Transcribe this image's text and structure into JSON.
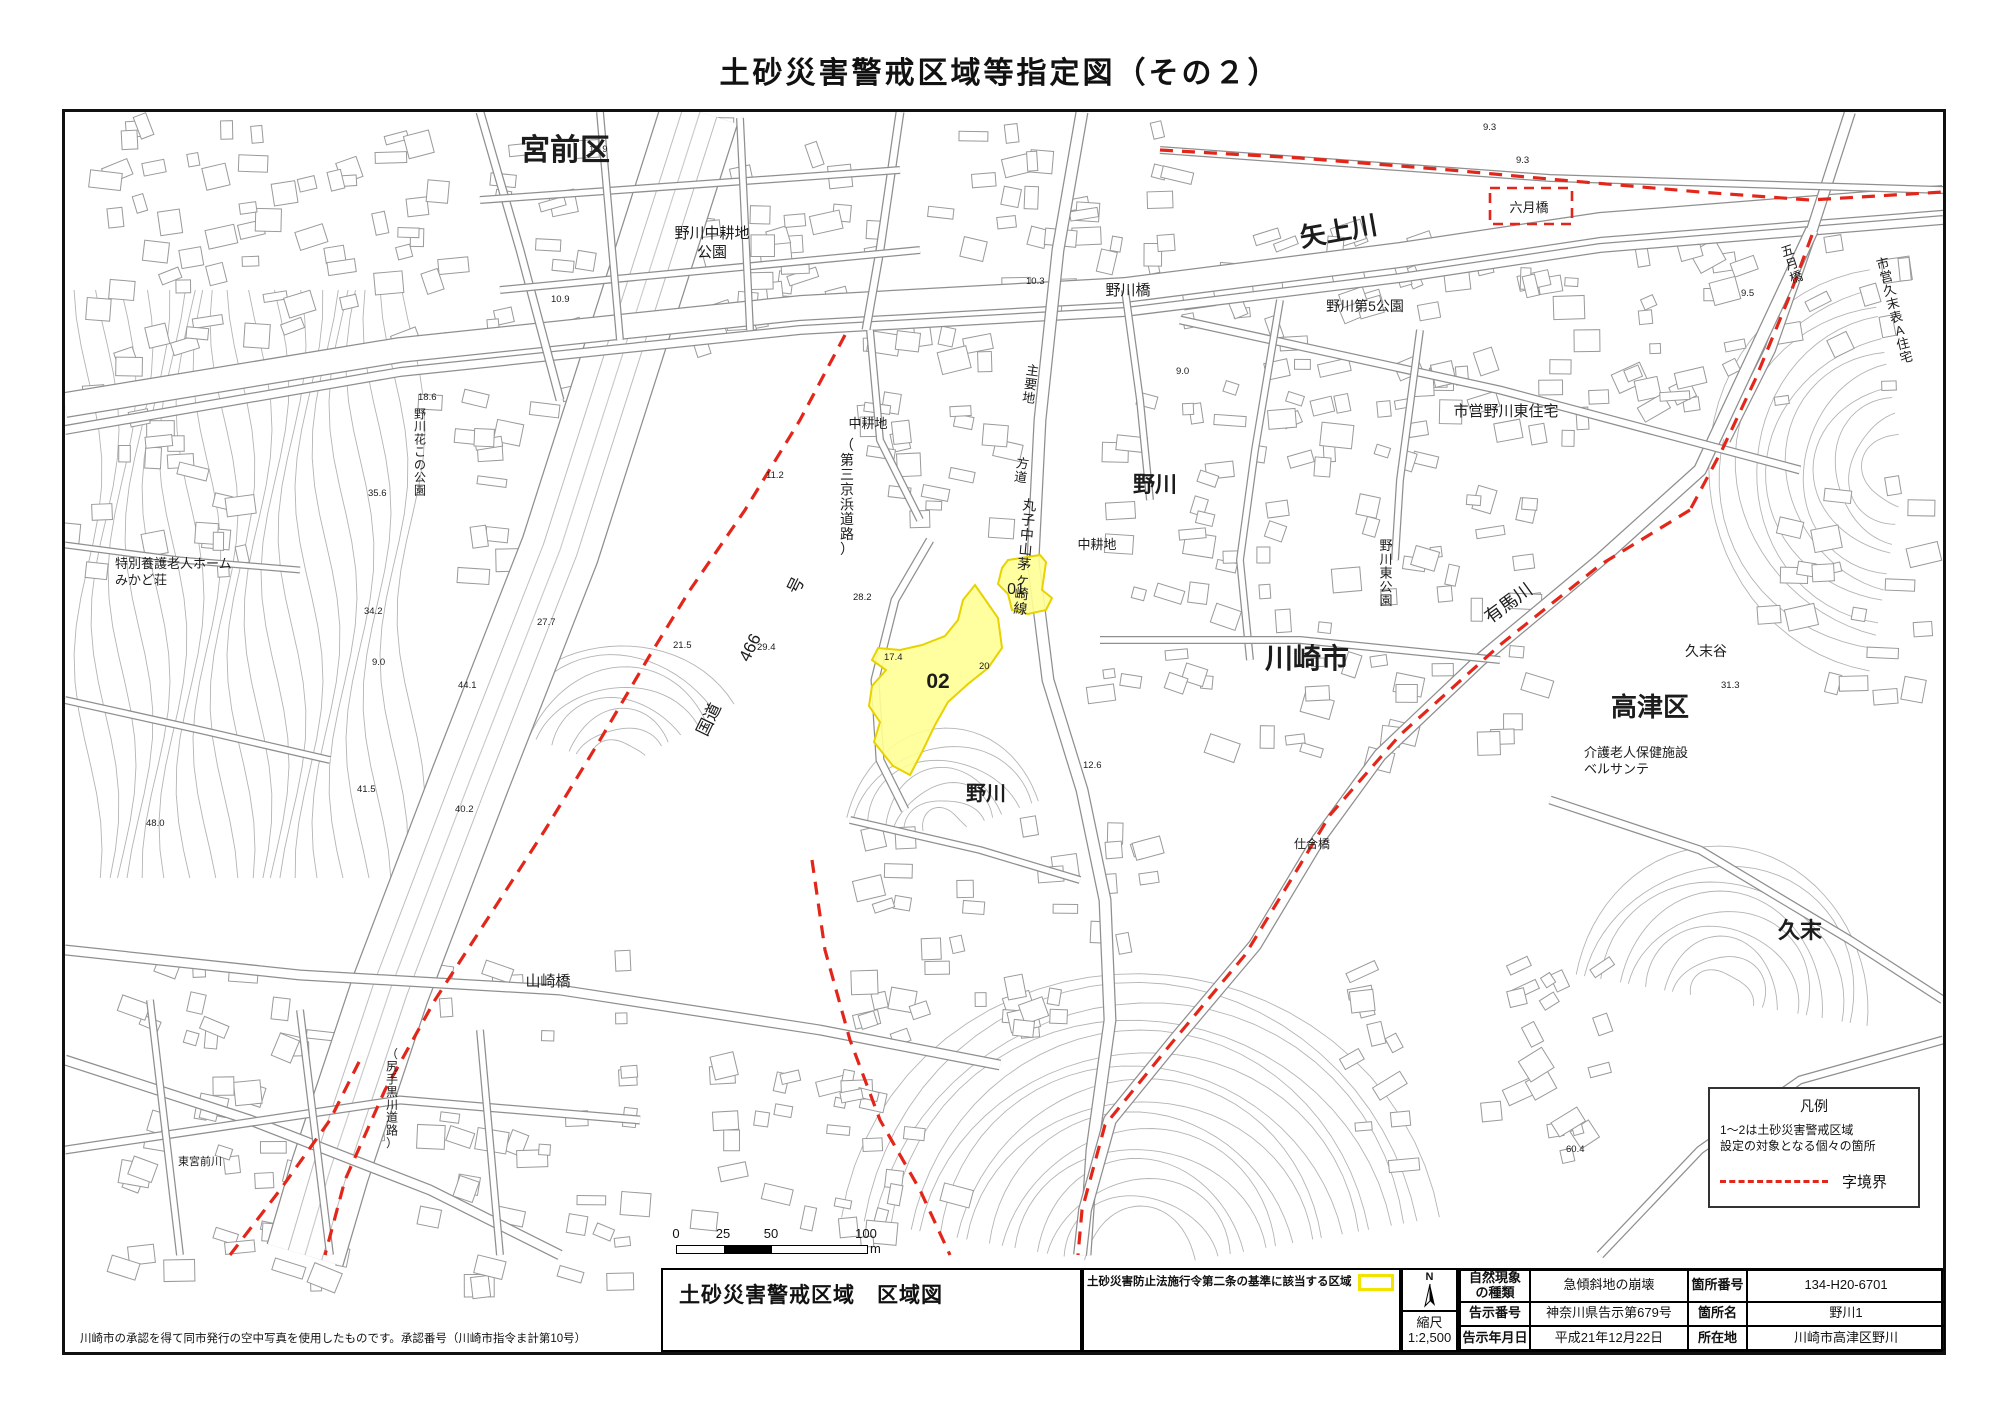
{
  "page_title": "土砂災害警戒区域等指定図（その２）",
  "map": {
    "labels": [
      {
        "t": "宮前区",
        "x": 565,
        "y": 160,
        "s": 30
      },
      {
        "t": "野川中耕地\n公園",
        "x": 712,
        "y": 238,
        "s": 15
      },
      {
        "t": "矢上川",
        "x": 1340,
        "y": 240,
        "s": 26,
        "r": -10
      },
      {
        "t": "野川橋",
        "x": 1128,
        "y": 295,
        "s": 15
      },
      {
        "t": "六月橋",
        "x": 1529,
        "y": 212,
        "s": 13
      },
      {
        "t": "五月橋",
        "x": 1789,
        "y": 255,
        "s": 13,
        "v": 1,
        "r": -18
      },
      {
        "t": "市営久末表A住宅",
        "x": 1884,
        "y": 268,
        "s": 13,
        "v": 1,
        "r": -14
      },
      {
        "t": "野川第5公園",
        "x": 1365,
        "y": 311,
        "s": 14
      },
      {
        "t": "市営野川東住宅",
        "x": 1506,
        "y": 416,
        "s": 15
      },
      {
        "t": "主要地",
        "x": 1032,
        "y": 375,
        "s": 13,
        "v": 1,
        "r": 8
      },
      {
        "t": "方道",
        "x": 1022,
        "y": 468,
        "s": 13,
        "v": 1,
        "r": 8
      },
      {
        "t": "丸子中山茅ヶ崎線",
        "x": 1029,
        "y": 510,
        "s": 14,
        "v": 1,
        "r": 5
      },
      {
        "t": "中耕地",
        "x": 868,
        "y": 428,
        "s": 13
      },
      {
        "t": "中耕地",
        "x": 1097,
        "y": 549,
        "s": 13
      },
      {
        "t": "01",
        "x": 1016,
        "y": 594,
        "s": 16
      },
      {
        "t": "02",
        "x": 938,
        "y": 688,
        "s": 21
      },
      {
        "t": "野川",
        "x": 1155,
        "y": 492,
        "s": 22
      },
      {
        "t": "野川",
        "x": 986,
        "y": 800,
        "s": 20
      },
      {
        "t": "川崎市",
        "x": 1307,
        "y": 668,
        "s": 28
      },
      {
        "t": "野川東公園",
        "x": 1386,
        "y": 550,
        "s": 13,
        "v": 1
      },
      {
        "t": "有馬川",
        "x": 1512,
        "y": 608,
        "s": 18,
        "r": -36
      },
      {
        "t": "久末谷",
        "x": 1706,
        "y": 656,
        "s": 14
      },
      {
        "t": "高津区",
        "x": 1650,
        "y": 716,
        "s": 26
      },
      {
        "t": "介護老人保健施設\nベルサンテ",
        "x": 1584,
        "y": 757,
        "s": 13,
        "a": "start"
      },
      {
        "t": "久末",
        "x": 1800,
        "y": 938,
        "s": 22
      },
      {
        "t": "山崎橋",
        "x": 548,
        "y": 986,
        "s": 15
      },
      {
        "t": "特別養護老人ホーム\nみかど荘",
        "x": 115,
        "y": 568,
        "s": 13,
        "a": "start"
      },
      {
        "t": "野川花この公園",
        "x": 420,
        "y": 418,
        "s": 12,
        "v": 1
      },
      {
        "t": "国道",
        "x": 714,
        "y": 722,
        "s": 17,
        "r": -64
      },
      {
        "t": "466",
        "x": 755,
        "y": 650,
        "s": 17,
        "r": -64
      },
      {
        "t": "号",
        "x": 801,
        "y": 588,
        "s": 17,
        "r": -64
      },
      {
        "t": "（第三京浜道路）",
        "x": 847,
        "y": 450,
        "s": 14,
        "v": 1
      },
      {
        "t": "仕合橋",
        "x": 1312,
        "y": 848,
        "s": 12
      },
      {
        "t": "（尻手黒川道路）",
        "x": 392,
        "y": 1058,
        "s": 12,
        "v": 1
      },
      {
        "t": "東宮前川",
        "x": 200,
        "y": 1165,
        "s": 11
      }
    ],
    "elevations": [
      {
        "t": "10.9",
        "x": 589,
        "y": 152
      },
      {
        "t": "10.9",
        "x": 551,
        "y": 302
      },
      {
        "t": "10.3",
        "x": 1026,
        "y": 284
      },
      {
        "t": "9.0",
        "x": 1176,
        "y": 374
      },
      {
        "t": "9.3",
        "x": 1516,
        "y": 163
      },
      {
        "t": "9.3",
        "x": 1483,
        "y": 130
      },
      {
        "t": "9.5",
        "x": 1741,
        "y": 296
      },
      {
        "t": "11.2",
        "x": 766,
        "y": 478
      },
      {
        "t": "21.5",
        "x": 673,
        "y": 648
      },
      {
        "t": "17.4",
        "x": 884,
        "y": 660
      },
      {
        "t": "20",
        "x": 979,
        "y": 669
      },
      {
        "t": "12.6",
        "x": 1083,
        "y": 768
      },
      {
        "t": "31.3",
        "x": 1721,
        "y": 688
      },
      {
        "t": "27.7",
        "x": 537,
        "y": 625
      },
      {
        "t": "29.4",
        "x": 757,
        "y": 650
      },
      {
        "t": "34.2",
        "x": 364,
        "y": 614
      },
      {
        "t": "18.6",
        "x": 418,
        "y": 400
      },
      {
        "t": "35.6",
        "x": 368,
        "y": 496
      },
      {
        "t": "28.2",
        "x": 853,
        "y": 600
      },
      {
        "t": "44.1",
        "x": 458,
        "y": 688
      },
      {
        "t": "40.2",
        "x": 455,
        "y": 812
      },
      {
        "t": "41.5",
        "x": 357,
        "y": 792
      },
      {
        "t": "48.0",
        "x": 146,
        "y": 826
      },
      {
        "t": "60.4",
        "x": 1566,
        "y": 1152
      },
      {
        "t": "9.0",
        "x": 372,
        "y": 665
      }
    ],
    "legend": {
      "title": "凡例",
      "note": "1～2は土砂災害警戒区域\n設定の対象となる個々の箇所",
      "boundary_label": "字境界"
    }
  },
  "scale_bar": {
    "ticks": [
      "0",
      "25",
      "50",
      "100"
    ],
    "unit": "m"
  },
  "footer": {
    "note": "川崎市の承認を得て同市発行の空中写真を使用したものです。承認番号（川崎市指令ま計第10号）",
    "map_title": "土砂災害警戒区域　区域図",
    "criteria_label": "土砂災害防止法施行令第二条の基準に該当する区域",
    "north_label": "N",
    "scale_label": "縮尺",
    "scale_value": "1:2,500",
    "table": {
      "rows": [
        {
          "h1": "自然現象\nの種類",
          "v1": "急傾斜地の崩壊",
          "h2": "箇所番号",
          "v2": "134-H20-6701"
        },
        {
          "h1": "告示番号",
          "v1": "神奈川県告示第679号",
          "h2": "箇所名",
          "v2": "野川1"
        },
        {
          "h1": "告示年月日",
          "v1": "平成21年12月22日",
          "h2": "所在地",
          "v2": "川崎市高津区野川"
        }
      ]
    }
  },
  "colors": {
    "boundary": "#e3261a",
    "zone_fill": "#ffff96",
    "zone_stroke": "#e8d200"
  }
}
